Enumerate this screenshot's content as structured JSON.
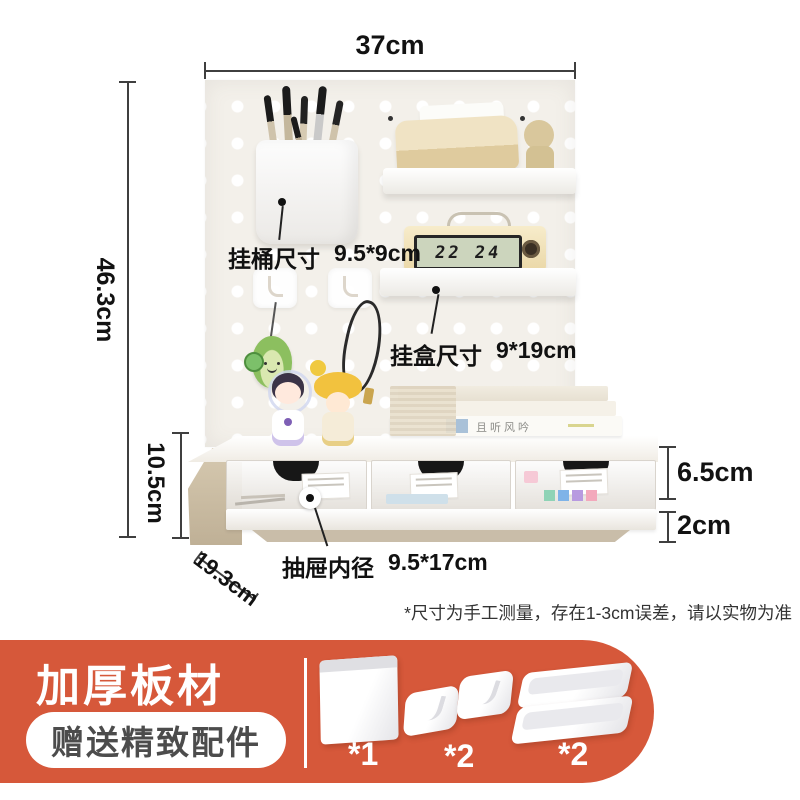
{
  "colors": {
    "banner": "#d6583a",
    "board": "#f3f0ea",
    "wood": "#cfc2a9"
  },
  "annotations": {
    "top_width": "37cm",
    "board_height": "46.3cm",
    "base_height": "10.5cm",
    "base_depth": "19.3cm",
    "drawer_face_height": "6.5cm",
    "bottom_clearance": "2cm",
    "bucket_label": "挂桶尺寸",
    "bucket_size": "9.5*9cm",
    "box_label": "挂盒尺寸",
    "box_size": "9*19cm",
    "drawer_label": "抽屉内径",
    "drawer_size": "9.5*17cm",
    "disclaimer": "*尺寸为手工测量，存在1-3cm误差，请以实物为准"
  },
  "photo_text": {
    "clock_display": "22 24",
    "book_spine": "且听风吟"
  },
  "banner": {
    "title": "加厚板材",
    "subtitle_pill": "赠送精致配件",
    "accessories": [
      {
        "icon": "bucket-thumb",
        "count": "*1"
      },
      {
        "icon": "hooks-thumb",
        "count": "*2"
      },
      {
        "icon": "trays-thumb",
        "count": "*2"
      }
    ]
  }
}
